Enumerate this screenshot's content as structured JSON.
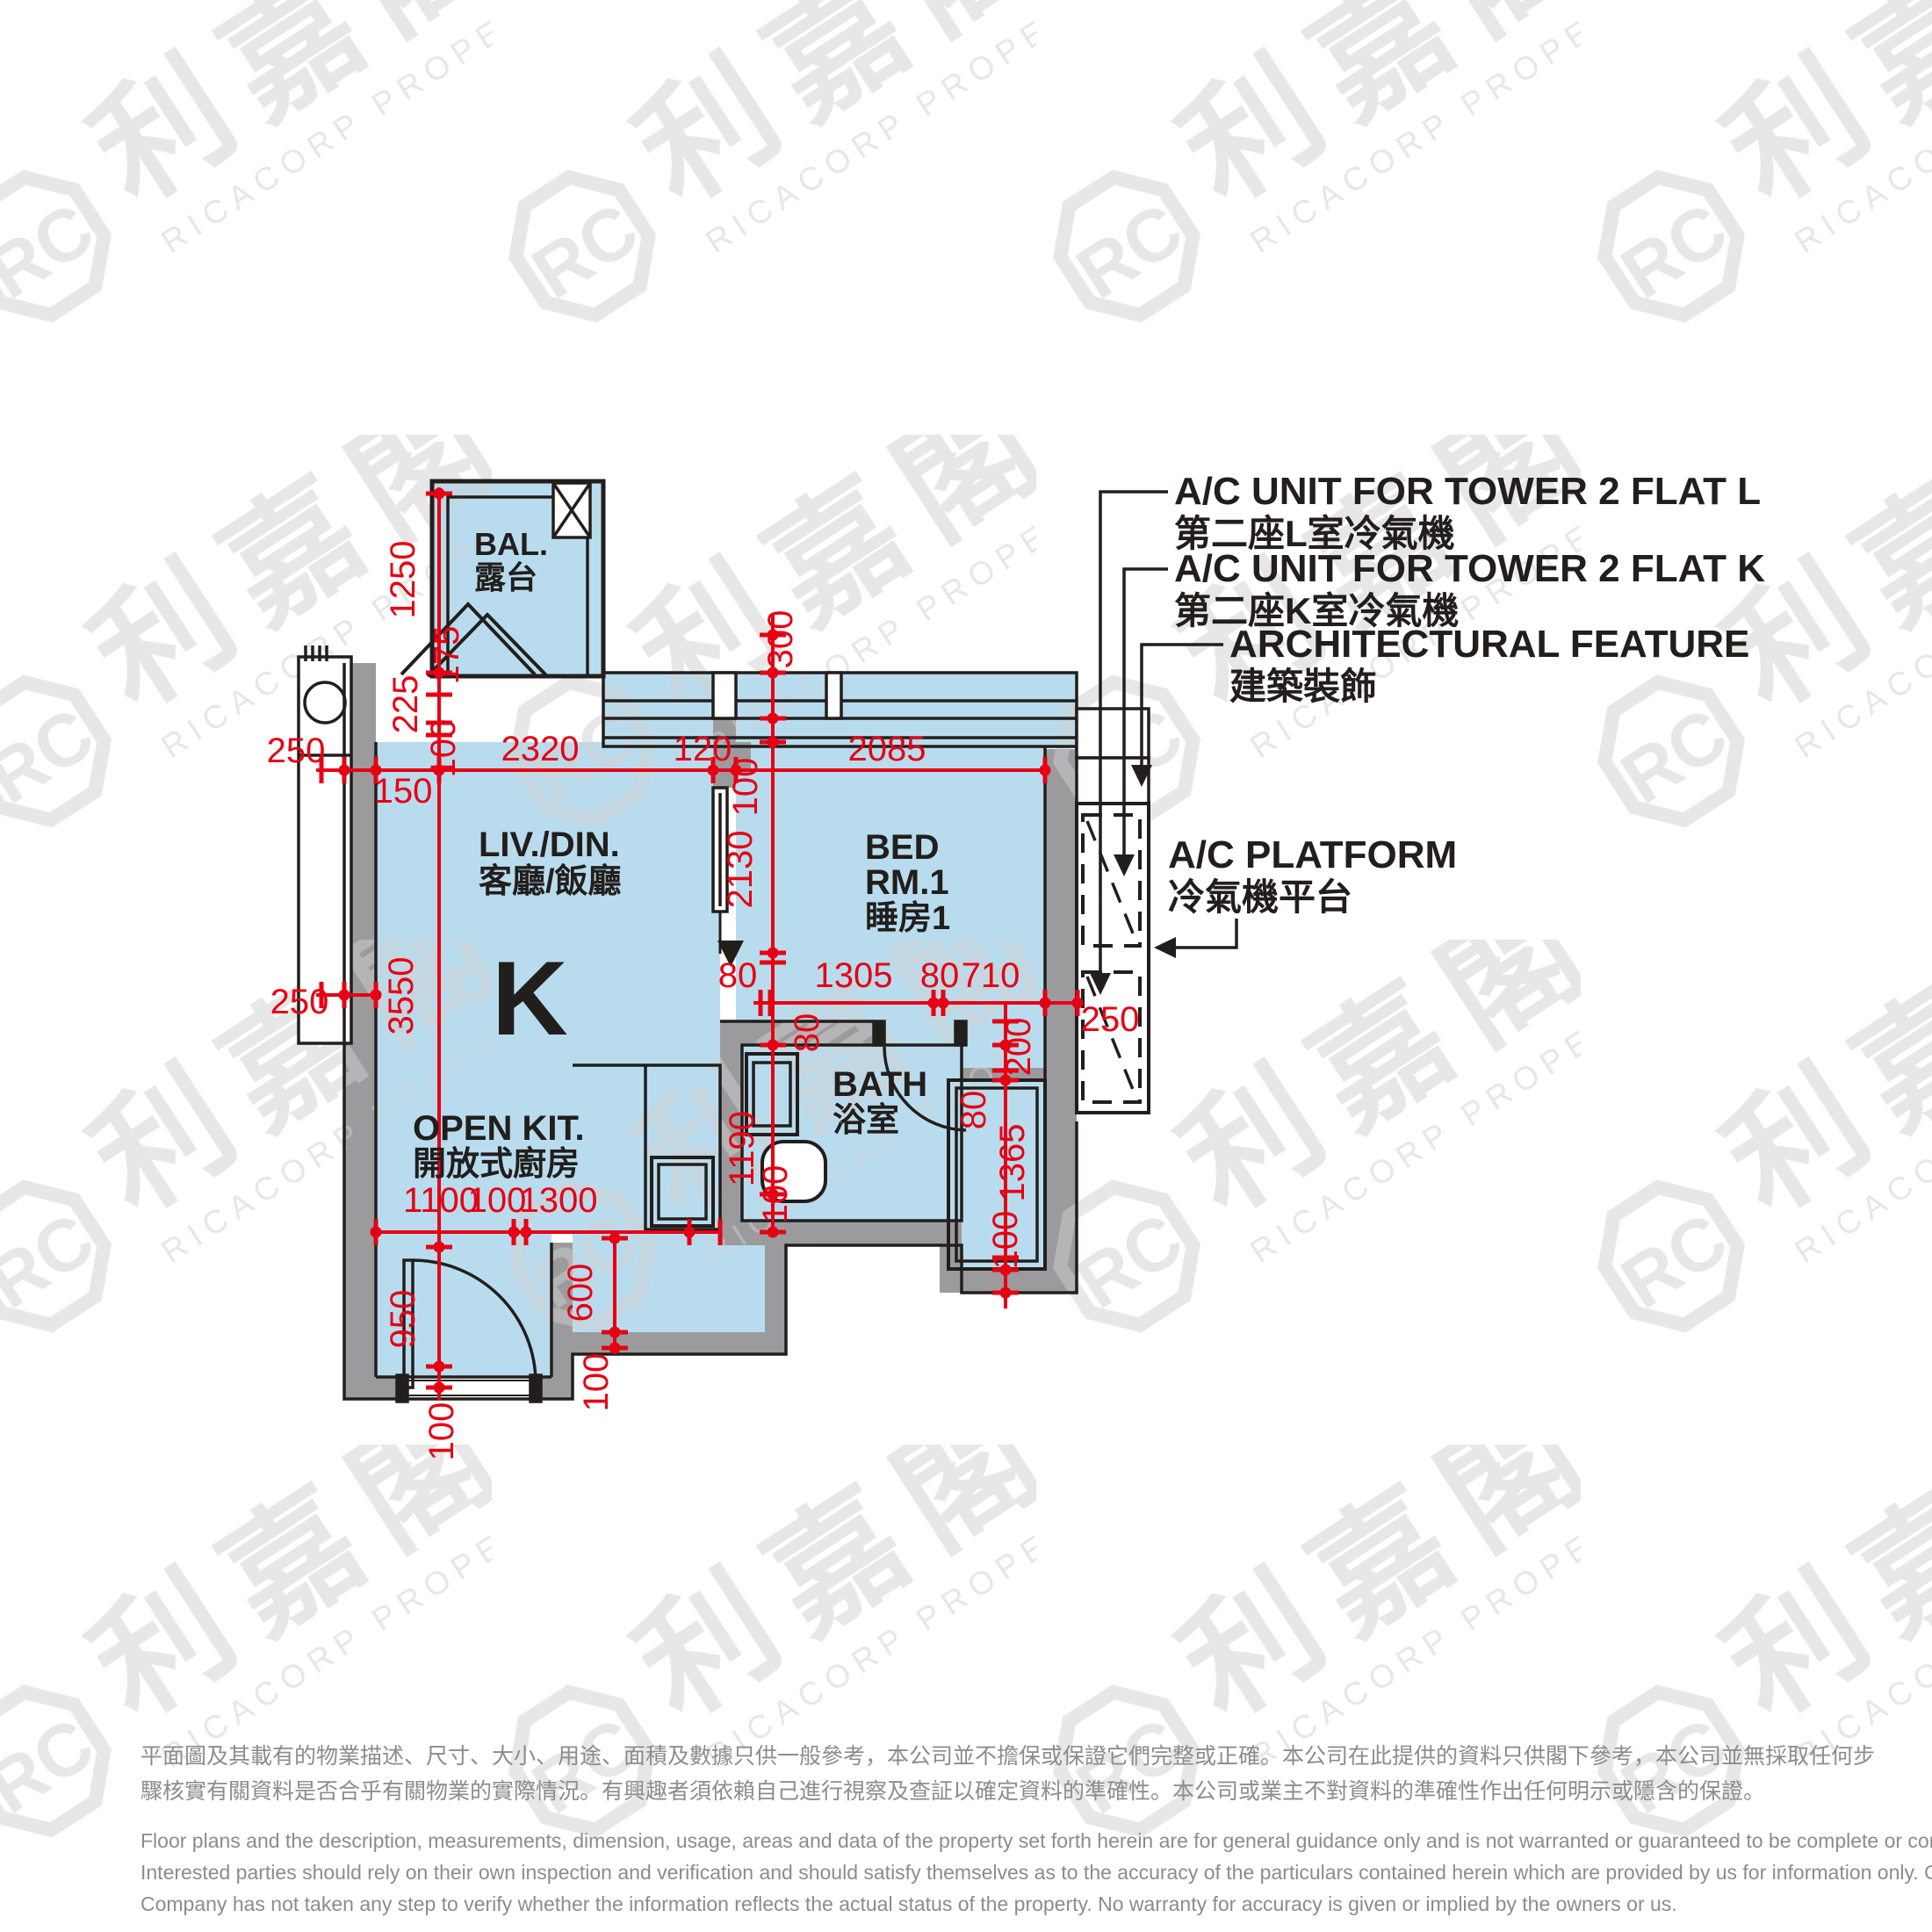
{
  "watermark": {
    "logo_text": "RC",
    "brand_zh": "利嘉閣",
    "brand_en": "RICACORP PROPERTIES"
  },
  "plan": {
    "flat_letter": "K",
    "rooms": {
      "balcony": {
        "en": "BAL.",
        "zh": "露台"
      },
      "living": {
        "en": "LIV./DIN.",
        "zh": "客廳/飯廳"
      },
      "bedroom": {
        "en": "BED",
        "en2": "RM.1",
        "zh": "睡房1"
      },
      "kitchen": {
        "en": "OPEN KIT.",
        "zh": "開放式廚房"
      },
      "bath": {
        "en": "BATH",
        "zh": "浴室"
      }
    },
    "callouts": {
      "ac_l": {
        "en": "A/C UNIT FOR TOWER 2 FLAT L",
        "zh": "第二座L室冷氣機"
      },
      "ac_k": {
        "en": "A/C UNIT FOR TOWER 2 FLAT K",
        "zh": "第二座K室冷氣機"
      },
      "feature": {
        "en": "ARCHITECTURAL FEATURE",
        "zh": "建築裝飾"
      },
      "platform": {
        "en": "A/C PLATFORM",
        "zh": "冷氣機平台"
      }
    },
    "dims": [
      "250",
      "150",
      "2320",
      "120",
      "2085",
      "100",
      "1250",
      "175",
      "225",
      "300",
      "100",
      "3550",
      "2130",
      "80",
      "1305",
      "80",
      "710",
      "250",
      "200",
      "80",
      "1365",
      "100",
      "80",
      "1190",
      "100",
      "250",
      "1100",
      "100",
      "1300",
      "600",
      "100",
      "950",
      "100"
    ]
  },
  "disclaimer": {
    "zh": [
      "平面圖及其載有的物業描述、尺寸、大小、用途、面積及數據只供一般參考，本公司並不擔保或保證它們完整或正確。本公司在此提供的資料只供閣下參考，本公司並無採取任何步",
      "驟核實有關資料是否合乎有關物業的實際情況。有興趣者須依賴自己進行視察及查証以確定資料的準確性。本公司或業主不對資料的準確性作出任何明示或隱含的保證。"
    ],
    "en": [
      "Floor plans and the description, measurements, dimension, usage, areas and data of the property set forth herein are for general guidance only and is not warranted or guaranteed to be complete or correct.",
      "Interested parties should rely on their own inspection and verification and should satisfy themselves as to the accuracy of the particulars contained herein which are provided by us for information only.  Our",
      "Company has not taken any step to verify whether the information reflects the actual status of the property.  No warranty for accuracy is given or implied by the owners or us."
    ]
  },
  "colors": {
    "room_fill": "#b8dcee",
    "wall": "#9b9b9e",
    "dim_red": "#e60013",
    "line_black": "#221e1c",
    "disclaimer_gray": "#8c8c8c",
    "watermark_gray": "#cfcfcf"
  }
}
